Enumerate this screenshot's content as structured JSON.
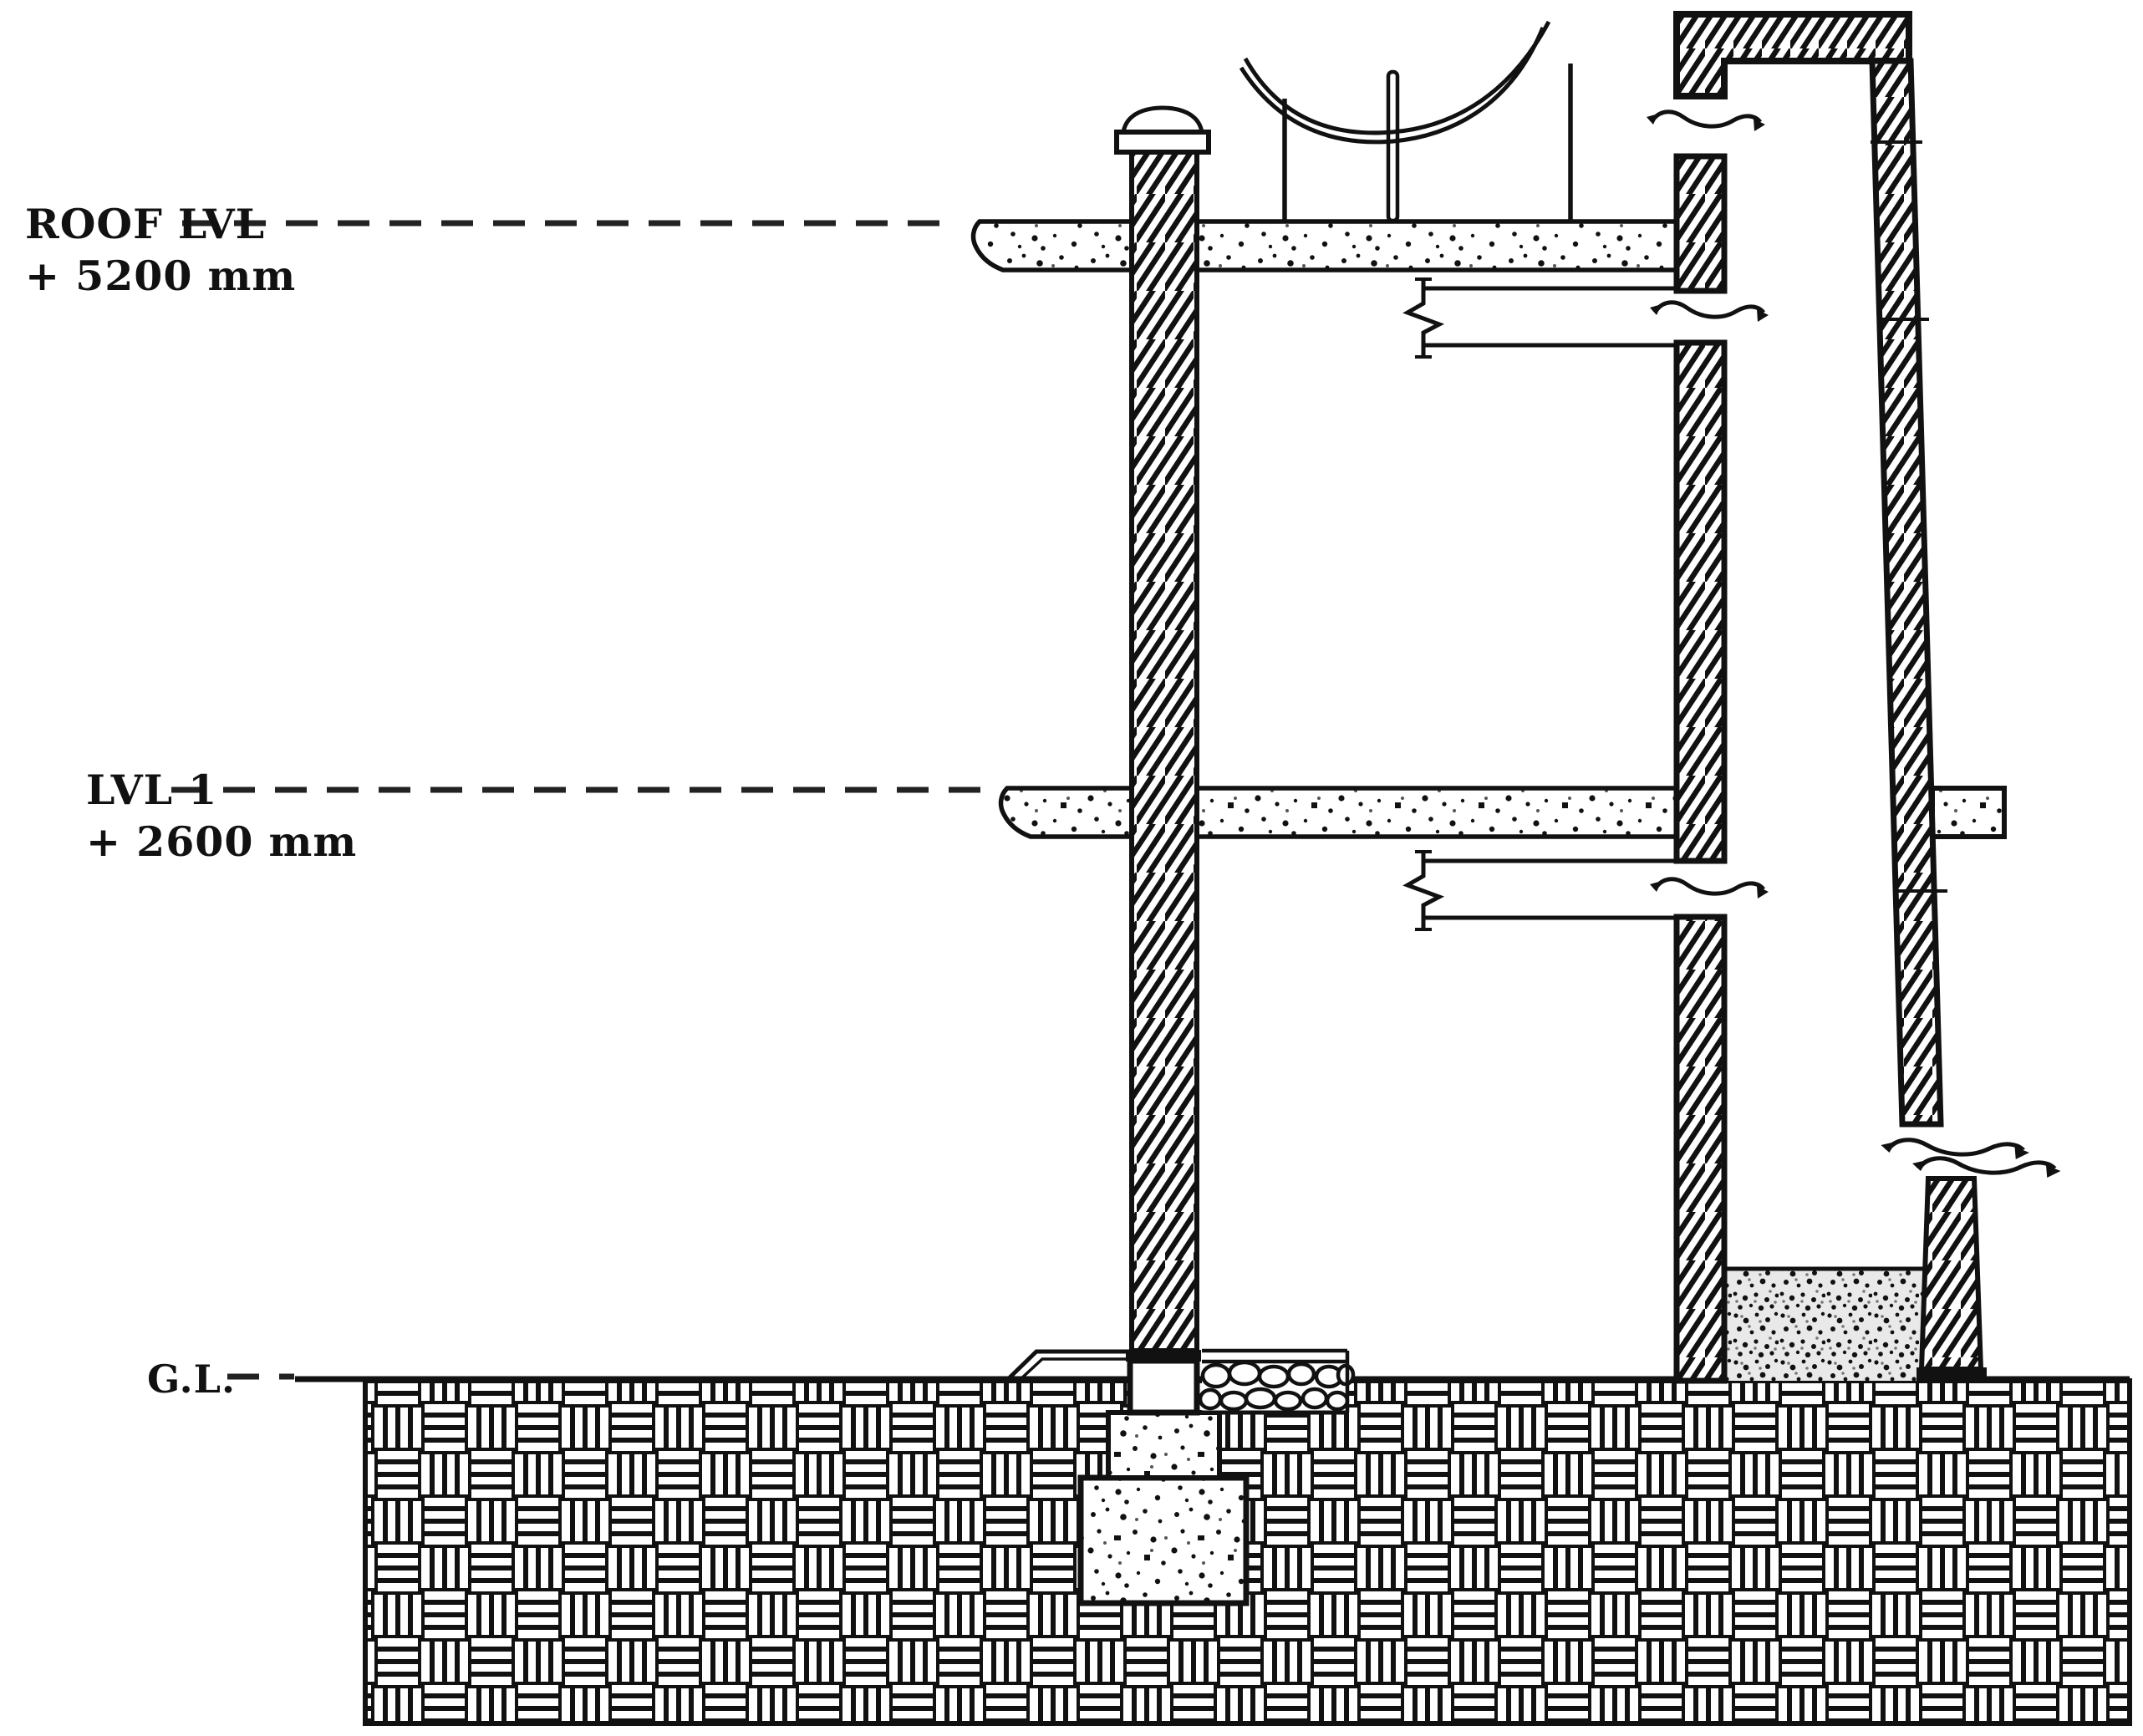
{
  "labels": {
    "roof_level": {
      "name": "ROOF LVL",
      "elevation": "+ 5200 mm"
    },
    "level_1": {
      "name": "LVL 1",
      "elevation": "+ 2600 mm"
    },
    "ground_level": {
      "name": "G.L."
    }
  },
  "colors": {
    "line": "#000000",
    "background": "#ffffff"
  }
}
